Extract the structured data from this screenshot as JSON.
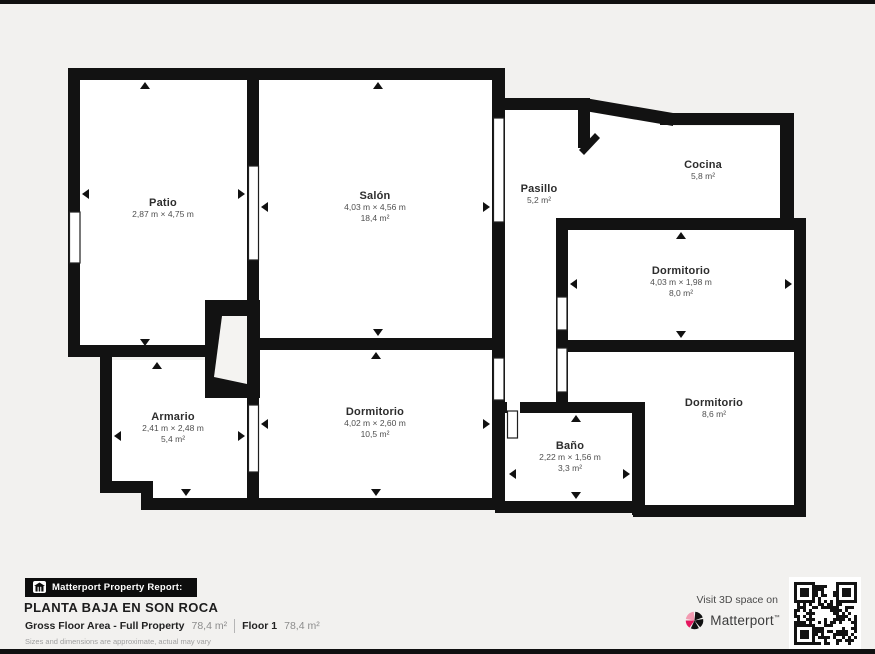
{
  "page": {
    "background": "#f2f1ef",
    "wall_color": "#121212",
    "room_fill": "#ffffff"
  },
  "floor_plan": {
    "rooms": [
      {
        "name": "Patio",
        "dimensions": "2,87 m × 4,75 m",
        "area": ""
      },
      {
        "name": "Salón",
        "dimensions": "4,03 m × 4,56 m",
        "area": "18,4 m²"
      },
      {
        "name": "Pasillo",
        "dimensions": "",
        "area": "5,2 m²"
      },
      {
        "name": "Cocina",
        "dimensions": "",
        "area": "5,8 m²"
      },
      {
        "name": "Dormitorio",
        "dimensions": "4,03 m × 1,98 m",
        "area": "8,0 m²"
      },
      {
        "name": "Dormitorio",
        "dimensions": "",
        "area": "8,6 m²"
      },
      {
        "name": "Dormitorio",
        "dimensions": "4,02 m × 2,60 m",
        "area": "10,5 m²"
      },
      {
        "name": "Armario",
        "dimensions": "2,41 m × 2,48 m",
        "area": "5,4 m²"
      },
      {
        "name": "Baño",
        "dimensions": "2,22 m × 1,56 m",
        "area": "3,3 m²"
      }
    ]
  },
  "footer": {
    "report_badge": "Matterport Property Report:",
    "plan_title": "PLANTA BAJA EN SON ROCA",
    "gross_label": "Gross Floor Area - Full Property",
    "gross_value": "78,4 m²",
    "floor_label": "Floor 1",
    "floor_value": "78,4 m²",
    "disclaimer": "Sizes and dimensions are approximate, actual may vary",
    "visit_text": "Visit 3D space on",
    "brand": "Matterport",
    "brand_tm": "™",
    "brand_pink": "#e5175f"
  }
}
